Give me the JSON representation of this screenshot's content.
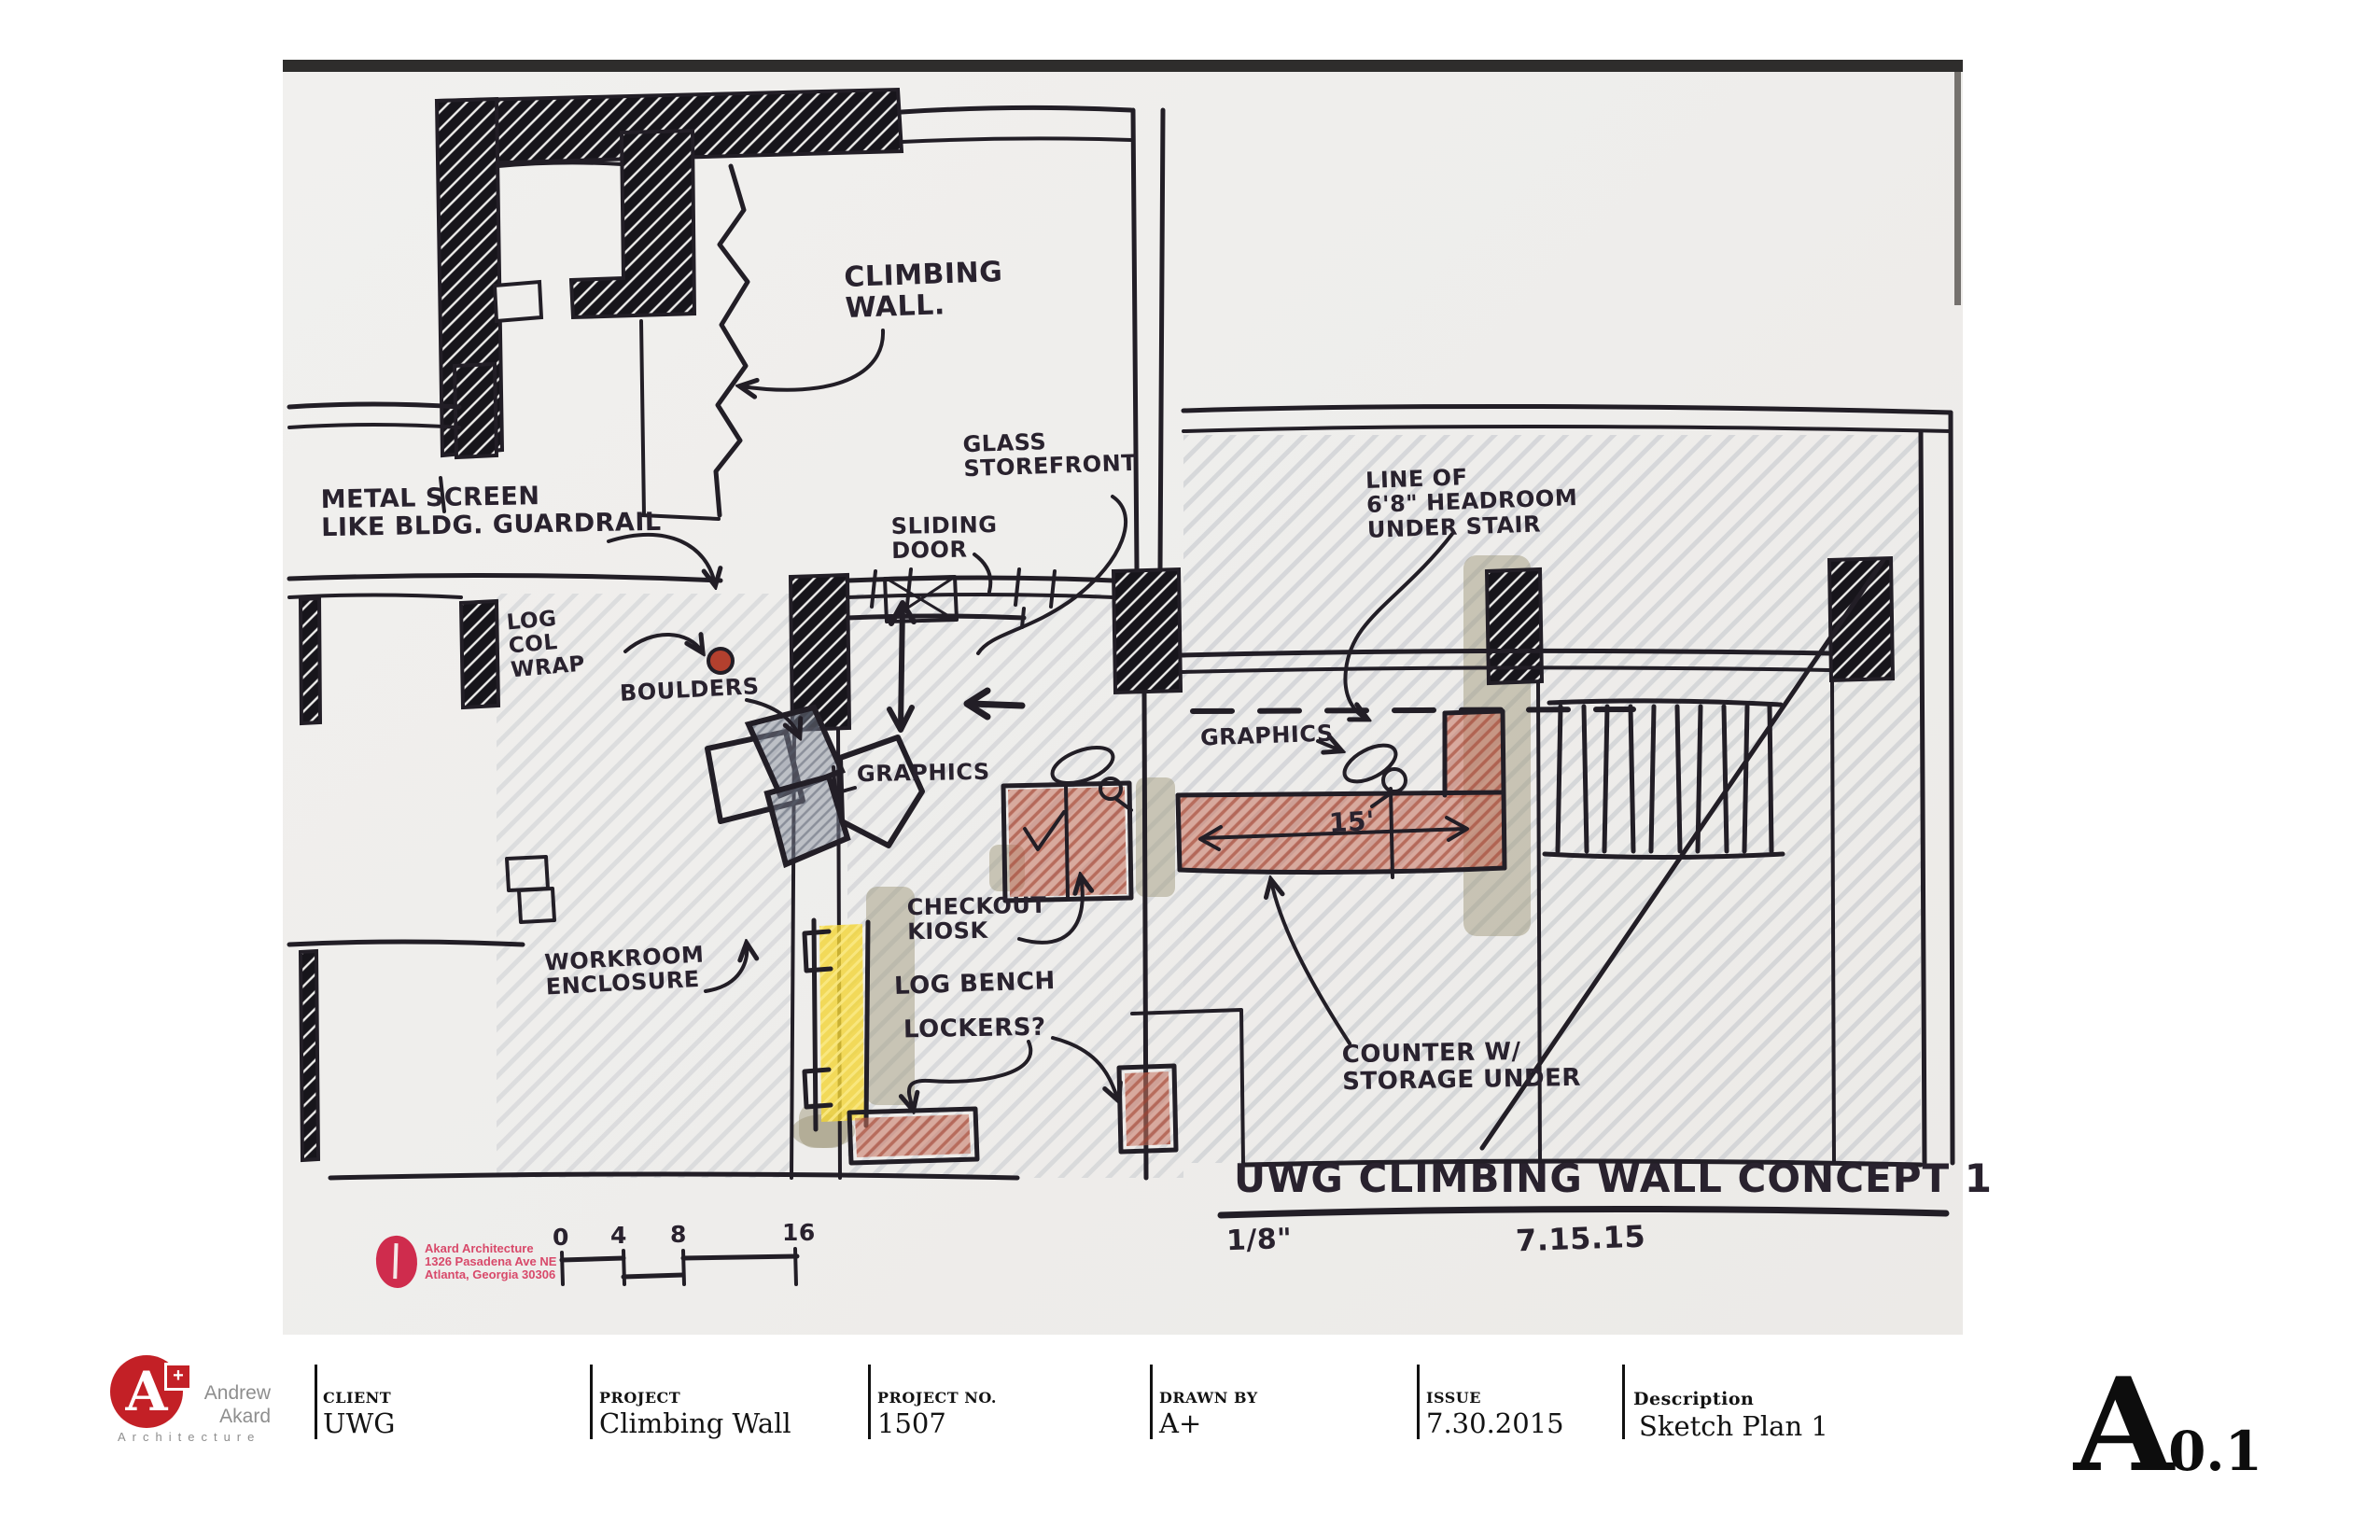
{
  "sheet": {
    "drawing": {
      "annotations": {
        "climbing_wall": "CLIMBING\nWALL.",
        "metal_screen": "METAL SCREEN\nLIKE BLDG. GUARDRAIL",
        "log_col_wrap": "LOG\nCOL\nWRAP",
        "boulders": "BOULDERS",
        "glass_storefront": "GLASS\nSTOREFRONT",
        "sliding_door": "SLIDING\nDOOR",
        "headroom": "LINE OF\n6'8\" HEADROOM\nUNDER STAIR",
        "graphics_left": "GRAPHICS",
        "graphics_right": "GRAPHICS",
        "dim_15": "15'",
        "checkout_kiosk": "CHECKOUT\nKIOSK",
        "workroom": "WORKROOM\nENCLOSURE",
        "log_bench": "LOG BENCH",
        "lockers": "LOCKERS?",
        "counter": "COUNTER W/\nSTORAGE UNDER"
      },
      "title": "UWG CLIMBING WALL CONCEPT 1",
      "scale_note": "1/8\"",
      "date_note": "7.15.15",
      "scale_bar": {
        "labels": [
          "0",
          "4",
          "8",
          "16"
        ]
      },
      "stamp": {
        "line1": "Akard Architecture",
        "line2": "1326 Pasadena Ave NE",
        "line3": "Atlanta, Georgia 30306"
      }
    }
  },
  "titleblock": {
    "logo": {
      "monogram": "A",
      "plus": "+",
      "name_line1": "Andrew",
      "name_line2": "Akard",
      "subtitle": "Architecture"
    },
    "fields": [
      {
        "label": "CLIENT",
        "value": "UWG"
      },
      {
        "label": "PROJECT",
        "value": "Climbing Wall"
      },
      {
        "label": "PROJECT NO.",
        "value": "1507"
      },
      {
        "label": "DRAWN BY",
        "value": "A+"
      },
      {
        "label": "ISSUE",
        "value": "7.30.2015"
      },
      {
        "label": "Description",
        "value": "Sketch Plan 1"
      }
    ],
    "sheet_letter": "A",
    "sheet_suffix": "0.1"
  },
  "colors": {
    "ink": "#221e26",
    "crayon_red": "#b45b49",
    "crayon_yellow": "#f2d327",
    "pencil_gray": "#aab0ba",
    "stamp_red": "#cf2c4d",
    "logo_red": "#c32026"
  }
}
